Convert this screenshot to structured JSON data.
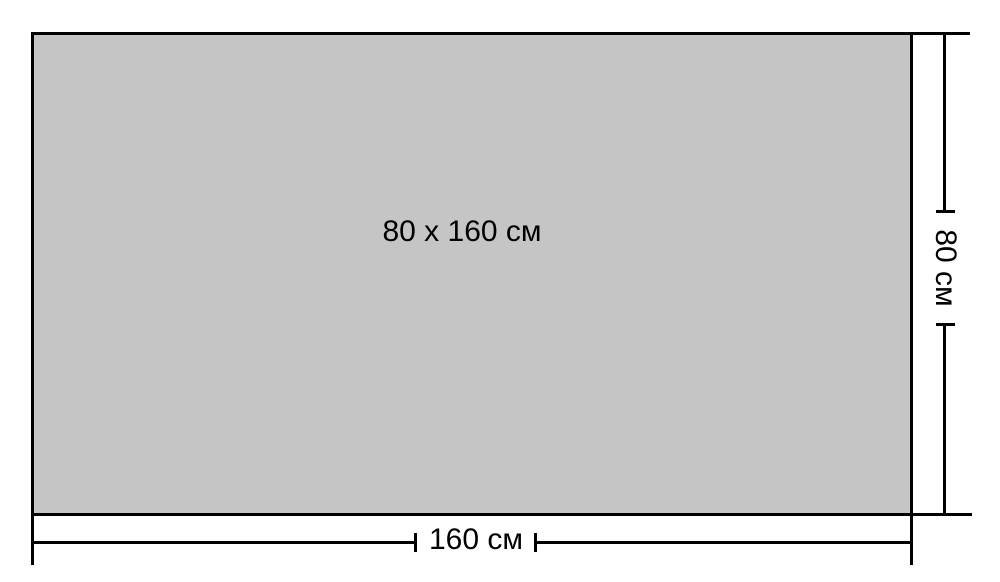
{
  "diagram": {
    "center_label": "80 x 160 см",
    "width_dimension": {
      "label": "160 см"
    },
    "height_dimension": {
      "label": "80 см"
    },
    "colors": {
      "background": "#ffffff",
      "rect_fill": "#c5c5c5",
      "line": "#000000"
    }
  }
}
